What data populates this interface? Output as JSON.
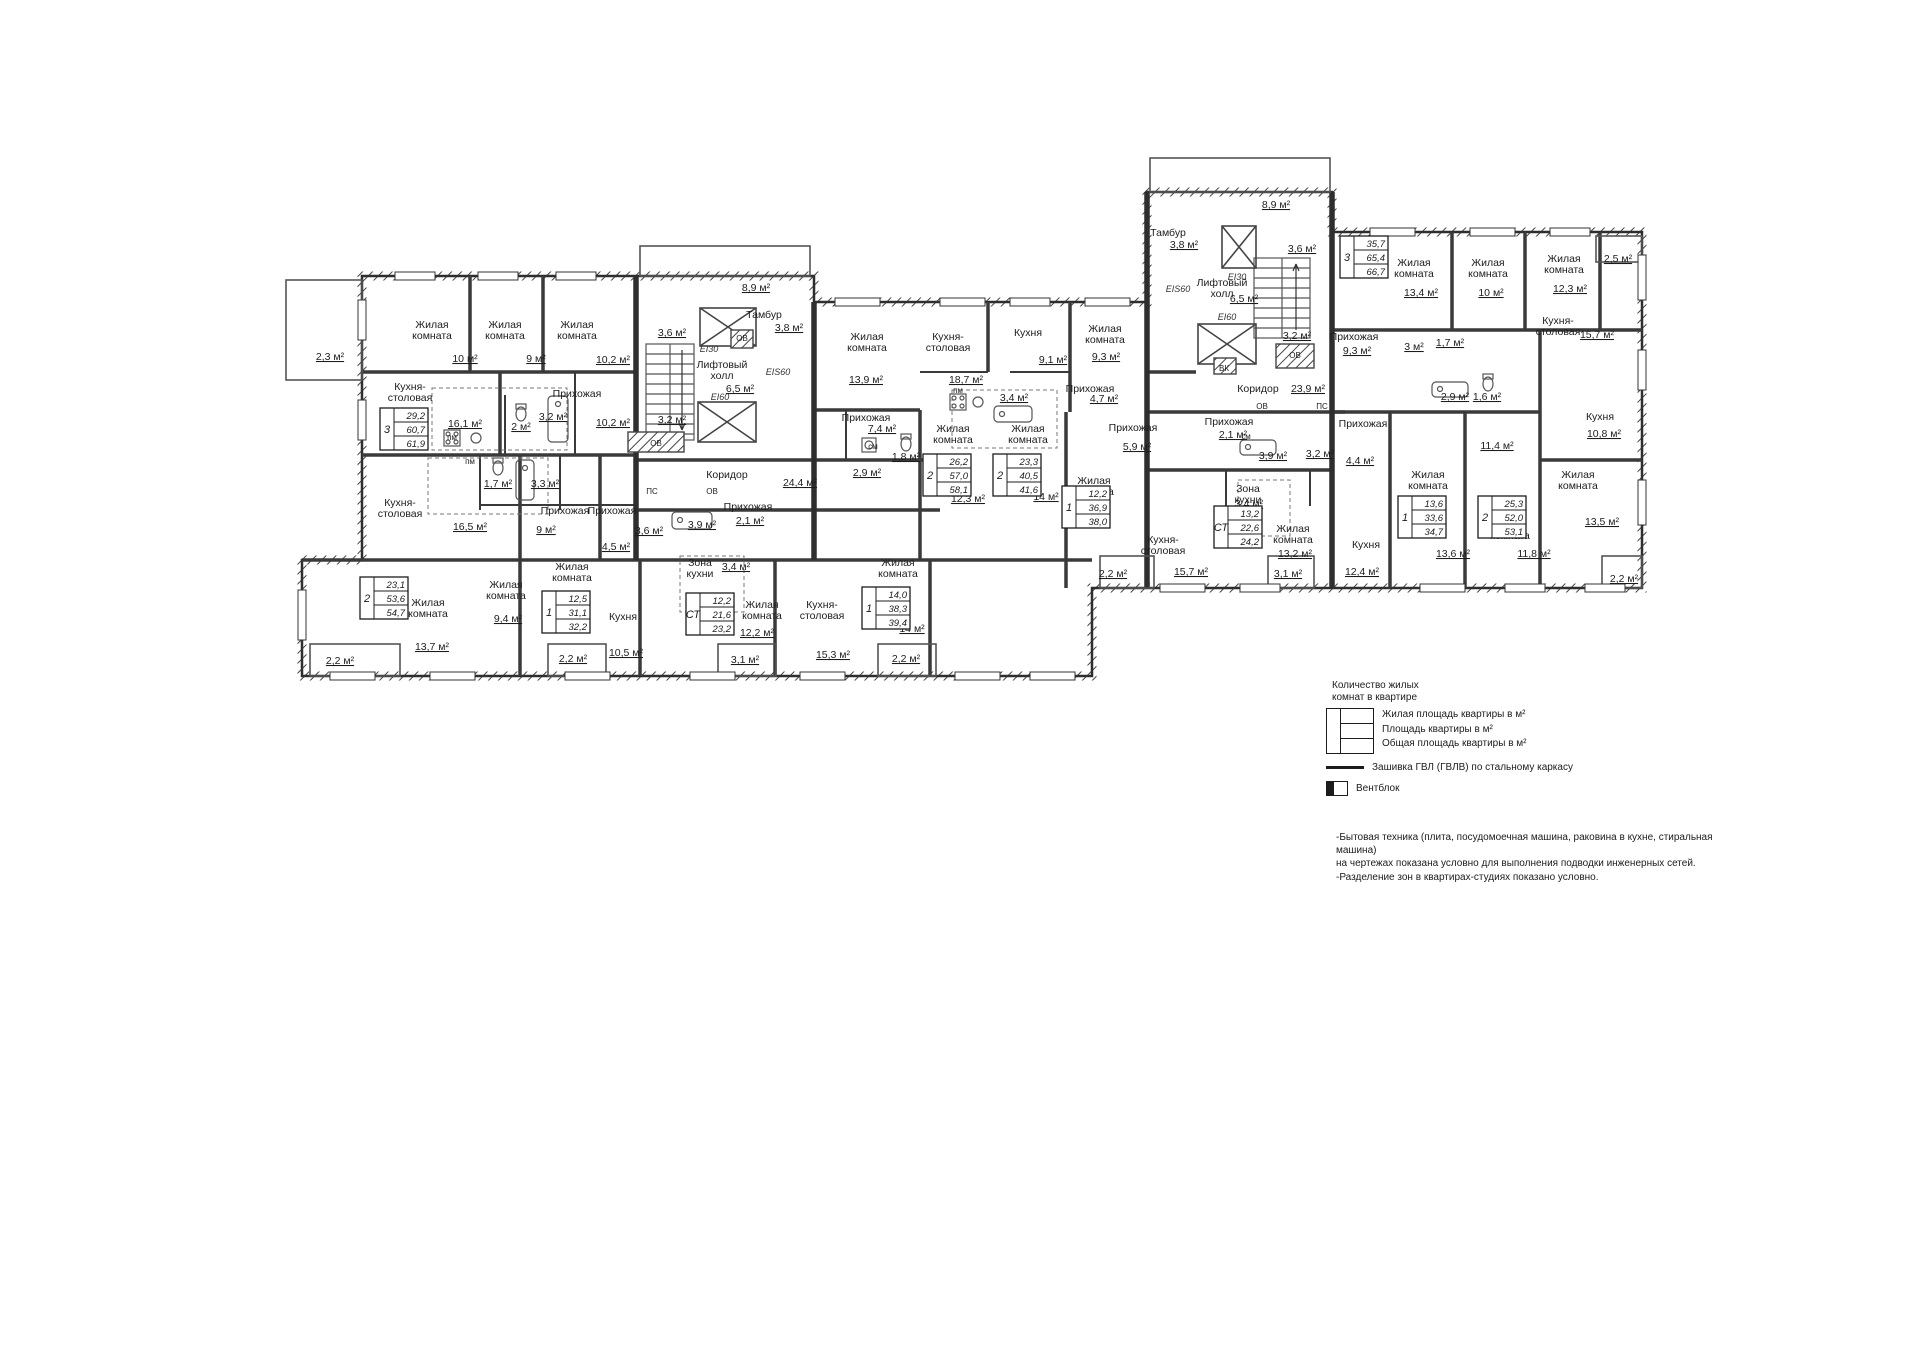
{
  "colors": {
    "ink": "#1c1c1c",
    "wall": "#2e2e2e",
    "wall_light": "#555555"
  },
  "plan": {
    "room_labels": [
      {
        "l": [
          "Жилая",
          "комната"
        ],
        "x": 432,
        "y": 328
      },
      {
        "l": [
          "Жилая",
          "комната"
        ],
        "x": 505,
        "y": 328
      },
      {
        "l": [
          "Жилая",
          "комната"
        ],
        "x": 577,
        "y": 328
      },
      {
        "l": [
          "Кухня-",
          "столовая"
        ],
        "x": 410,
        "y": 390
      },
      {
        "l": [
          "Прихожая"
        ],
        "x": 577,
        "y": 397
      },
      {
        "l": [
          "Кухня-",
          "столовая"
        ],
        "x": 400,
        "y": 506
      },
      {
        "l": [
          "Прихожая"
        ],
        "x": 565,
        "y": 514
      },
      {
        "l": [
          "Прихожая"
        ],
        "x": 612,
        "y": 514
      },
      {
        "l": [
          "Прихожая"
        ],
        "x": 748,
        "y": 510
      },
      {
        "l": [
          "Коридор"
        ],
        "x": 727,
        "y": 478
      },
      {
        "l": [
          "Жилая",
          "комната"
        ],
        "x": 428,
        "y": 606
      },
      {
        "l": [
          "Жилая",
          "комната"
        ],
        "x": 506,
        "y": 588
      },
      {
        "l": [
          "Жилая",
          "комната"
        ],
        "x": 572,
        "y": 570
      },
      {
        "l": [
          "Кухня"
        ],
        "x": 623,
        "y": 620
      },
      {
        "l": [
          "Зона",
          "кухни"
        ],
        "x": 700,
        "y": 566
      },
      {
        "l": [
          "Жилая",
          "комната"
        ],
        "x": 762,
        "y": 608
      },
      {
        "l": [
          "Кухня-",
          "столовая"
        ],
        "x": 822,
        "y": 608
      },
      {
        "l": [
          "Жилая",
          "комната"
        ],
        "x": 898,
        "y": 566
      },
      {
        "l": [
          "Тамбур"
        ],
        "x": 764,
        "y": 318
      },
      {
        "l": [
          "Лифтовый",
          "холл"
        ],
        "x": 722,
        "y": 368
      },
      {
        "l": [
          "Жилая",
          "комната"
        ],
        "x": 867,
        "y": 340
      },
      {
        "l": [
          "Кухня-",
          "столовая"
        ],
        "x": 948,
        "y": 340
      },
      {
        "l": [
          "Прихожая"
        ],
        "x": 866,
        "y": 421
      },
      {
        "l": [
          "Жилая",
          "комната"
        ],
        "x": 953,
        "y": 432
      },
      {
        "l": [
          "Кухня"
        ],
        "x": 1028,
        "y": 336
      },
      {
        "l": [
          "Жилая",
          "комната"
        ],
        "x": 1105,
        "y": 332
      },
      {
        "l": [
          "Прихожая"
        ],
        "x": 1090,
        "y": 392
      },
      {
        "l": [
          "Жилая",
          "комната"
        ],
        "x": 1028,
        "y": 432
      },
      {
        "l": [
          "Прихожая"
        ],
        "x": 1133,
        "y": 431
      },
      {
        "l": [
          "Жилая",
          "комната"
        ],
        "x": 1094,
        "y": 484
      },
      {
        "l": [
          "Кухня-",
          "столовая"
        ],
        "x": 1163,
        "y": 543
      },
      {
        "l": [
          "Зона",
          "кухни"
        ],
        "x": 1248,
        "y": 492
      },
      {
        "l": [
          "Жилая",
          "комната"
        ],
        "x": 1293,
        "y": 532
      },
      {
        "l": [
          "Тамбур"
        ],
        "x": 1168,
        "y": 236
      },
      {
        "l": [
          "Лифтовый",
          "холл"
        ],
        "x": 1222,
        "y": 286
      },
      {
        "l": [
          "Коридор"
        ],
        "x": 1258,
        "y": 392
      },
      {
        "l": [
          "Прихожая"
        ],
        "x": 1229,
        "y": 425
      },
      {
        "l": [
          "Прихожая"
        ],
        "x": 1363,
        "y": 427
      },
      {
        "l": [
          "Прихожая"
        ],
        "x": 1354,
        "y": 340
      },
      {
        "l": [
          "Жилая",
          "комната"
        ],
        "x": 1414,
        "y": 266
      },
      {
        "l": [
          "Жилая",
          "комната"
        ],
        "x": 1488,
        "y": 266
      },
      {
        "l": [
          "Жилая",
          "комната"
        ],
        "x": 1564,
        "y": 262
      },
      {
        "l": [
          "Кухня-",
          "столовая"
        ],
        "x": 1558,
        "y": 324
      },
      {
        "l": [
          "Кухня"
        ],
        "x": 1600,
        "y": 420
      },
      {
        "l": [
          "Жилая",
          "комната"
        ],
        "x": 1578,
        "y": 478
      },
      {
        "l": [
          "Жилая",
          "комната"
        ],
        "x": 1428,
        "y": 478
      },
      {
        "l": [
          "Кухня"
        ],
        "x": 1366,
        "y": 548
      },
      {
        "l": [
          "Жилая",
          "комната"
        ],
        "x": 1510,
        "y": 528
      }
    ],
    "area_labels": [
      {
        "t": "10 м²",
        "x": 465,
        "y": 362
      },
      {
        "t": "9 м²",
        "x": 536,
        "y": 362
      },
      {
        "t": "10,2 м²",
        "x": 613,
        "y": 363
      },
      {
        "t": "2,3 м²",
        "x": 330,
        "y": 360
      },
      {
        "t": "16,1 м²",
        "x": 465,
        "y": 427
      },
      {
        "t": "2 м²",
        "x": 521,
        "y": 430
      },
      {
        "t": "3,2 м²",
        "x": 553,
        "y": 420
      },
      {
        "t": "10,2 м²",
        "x": 613,
        "y": 426
      },
      {
        "t": "3,2 м²",
        "x": 672,
        "y": 423
      },
      {
        "t": "1,7 м²",
        "x": 498,
        "y": 487
      },
      {
        "t": "3,3 м²",
        "x": 545,
        "y": 487
      },
      {
        "t": "16,5 м²",
        "x": 470,
        "y": 530
      },
      {
        "t": "9 м²",
        "x": 546,
        "y": 533
      },
      {
        "t": "4,5 м²",
        "x": 616,
        "y": 550
      },
      {
        "t": "3,6 м²",
        "x": 649,
        "y": 534
      },
      {
        "t": "3,9 м²",
        "x": 702,
        "y": 528
      },
      {
        "t": "2,1 м²",
        "x": 750,
        "y": 524
      },
      {
        "t": "24,4 м²",
        "x": 800,
        "y": 486
      },
      {
        "t": "13,7 м²",
        "x": 432,
        "y": 650
      },
      {
        "t": "9,4 м²",
        "x": 508,
        "y": 622
      },
      {
        "t": "2,2 м²",
        "x": 340,
        "y": 664
      },
      {
        "t": "2,2 м²",
        "x": 573,
        "y": 662
      },
      {
        "t": "10,5 м²",
        "x": 626,
        "y": 656
      },
      {
        "t": "3,4 м²",
        "x": 736,
        "y": 570
      },
      {
        "t": "12,2 м²",
        "x": 757,
        "y": 636
      },
      {
        "t": "3,1 м²",
        "x": 745,
        "y": 663
      },
      {
        "t": "15,3 м²",
        "x": 833,
        "y": 658
      },
      {
        "t": "14 м²",
        "x": 912,
        "y": 632
      },
      {
        "t": "2,2 м²",
        "x": 906,
        "y": 662
      },
      {
        "t": "8,9 м²",
        "x": 756,
        "y": 291
      },
      {
        "t": "3,8 м²",
        "x": 789,
        "y": 331
      },
      {
        "t": "3,6 м²",
        "x": 672,
        "y": 336
      },
      {
        "t": "6,5 м²",
        "x": 740,
        "y": 392
      },
      {
        "t": "13,9 м²",
        "x": 866,
        "y": 383
      },
      {
        "t": "18,7 м²",
        "x": 966,
        "y": 383
      },
      {
        "t": "7,4 м²",
        "x": 882,
        "y": 432
      },
      {
        "t": "2,9 м²",
        "x": 867,
        "y": 476
      },
      {
        "t": "1,8 м²",
        "x": 906,
        "y": 460
      },
      {
        "t": "12,3 м²",
        "x": 968,
        "y": 502
      },
      {
        "t": "9,1 м²",
        "x": 1053,
        "y": 363
      },
      {
        "t": "9,3 м²",
        "x": 1106,
        "y": 360
      },
      {
        "t": "4,7 м²",
        "x": 1104,
        "y": 402
      },
      {
        "t": "3,4 м²",
        "x": 1014,
        "y": 401
      },
      {
        "t": "14 м²",
        "x": 1046,
        "y": 500
      },
      {
        "t": "5,9 м²",
        "x": 1137,
        "y": 450
      },
      {
        "t": "2,2 м²",
        "x": 1113,
        "y": 577
      },
      {
        "t": "15,7 м²",
        "x": 1191,
        "y": 575
      },
      {
        "t": "3,4 м²",
        "x": 1249,
        "y": 507
      },
      {
        "t": "13,2 м²",
        "x": 1295,
        "y": 557
      },
      {
        "t": "3,1 м²",
        "x": 1288,
        "y": 577
      },
      {
        "t": "8,9 м²",
        "x": 1276,
        "y": 208
      },
      {
        "t": "3,8 м²",
        "x": 1184,
        "y": 248
      },
      {
        "t": "3,6 м²",
        "x": 1302,
        "y": 252
      },
      {
        "t": "6,5 м²",
        "x": 1244,
        "y": 302
      },
      {
        "t": "23,9 м²",
        "x": 1308,
        "y": 392
      },
      {
        "t": "2,1 м²",
        "x": 1233,
        "y": 438
      },
      {
        "t": "3,9 м²",
        "x": 1273,
        "y": 459
      },
      {
        "t": "3,2 м²",
        "x": 1320,
        "y": 457
      },
      {
        "t": "4,4 м²",
        "x": 1360,
        "y": 464
      },
      {
        "t": "9,3 м²",
        "x": 1357,
        "y": 354
      },
      {
        "t": "13,4 м²",
        "x": 1421,
        "y": 296
      },
      {
        "t": "10 м²",
        "x": 1491,
        "y": 296
      },
      {
        "t": "12,3 м²",
        "x": 1570,
        "y": 292
      },
      {
        "t": "2,5 м²",
        "x": 1618,
        "y": 262
      },
      {
        "t": "15,7 м²",
        "x": 1597,
        "y": 338
      },
      {
        "t": "1,7 м²",
        "x": 1450,
        "y": 346
      },
      {
        "t": "3 м²",
        "x": 1414,
        "y": 350
      },
      {
        "t": "2,9 м²",
        "x": 1455,
        "y": 400
      },
      {
        "t": "1,6 м²",
        "x": 1487,
        "y": 400
      },
      {
        "t": "10,8 м²",
        "x": 1604,
        "y": 437
      },
      {
        "t": "13,5 м²",
        "x": 1602,
        "y": 525
      },
      {
        "t": "11,4 м²",
        "x": 1497,
        "y": 449
      },
      {
        "t": "13,6 м²",
        "x": 1453,
        "y": 557
      },
      {
        "t": "11,8 м²",
        "x": 1534,
        "y": 557
      },
      {
        "t": "12,4 м²",
        "x": 1362,
        "y": 575
      },
      {
        "t": "2,2 м²",
        "x": 1624,
        "y": 582
      },
      {
        "t": "3,2 м²",
        "x": 1297,
        "y": 339
      }
    ],
    "tag_labels": [
      {
        "t": "ПС",
        "x": 652,
        "y": 494
      },
      {
        "t": "ОВ",
        "x": 712,
        "y": 494
      },
      {
        "t": "ОВ",
        "x": 656,
        "y": 446
      },
      {
        "t": "ОВ",
        "x": 742,
        "y": 341
      },
      {
        "t": "ВК",
        "x": 1224,
        "y": 371
      },
      {
        "t": "ОВ",
        "x": 1295,
        "y": 358
      },
      {
        "t": "ПС",
        "x": 1322,
        "y": 409
      },
      {
        "t": "ОВ",
        "x": 1262,
        "y": 409
      },
      {
        "t": "пм",
        "x": 452,
        "y": 440
      },
      {
        "t": "пм",
        "x": 470,
        "y": 464
      },
      {
        "t": "пм",
        "x": 958,
        "y": 393
      },
      {
        "t": "см",
        "x": 873,
        "y": 449
      },
      {
        "t": "см",
        "x": 1246,
        "y": 439
      }
    ],
    "ei_labels": [
      {
        "t": "EI30",
        "x": 709,
        "y": 352
      },
      {
        "t": "EI60",
        "x": 720,
        "y": 400
      },
      {
        "t": "EIS60",
        "x": 778,
        "y": 375
      },
      {
        "t": "EI30",
        "x": 1237,
        "y": 280
      },
      {
        "t": "EI60",
        "x": 1227,
        "y": 320
      },
      {
        "t": "EIS60",
        "x": 1178,
        "y": 292
      }
    ],
    "tables": [
      {
        "x": 380,
        "y": 408,
        "rooms": "3",
        "living": "29,2",
        "area": "60,7",
        "total": "61,9"
      },
      {
        "x": 360,
        "y": 577,
        "rooms": "2",
        "living": "23,1",
        "area": "53,6",
        "total": "54,7"
      },
      {
        "x": 542,
        "y": 591,
        "rooms": "1",
        "living": "12,5",
        "area": "31,1",
        "total": "32,2"
      },
      {
        "x": 686,
        "y": 593,
        "rooms": "СТ",
        "living": "12,2",
        "area": "21,6",
        "total": "23,2"
      },
      {
        "x": 862,
        "y": 587,
        "rooms": "1",
        "living": "14,0",
        "area": "38,3",
        "total": "39,4"
      },
      {
        "x": 923,
        "y": 454,
        "rooms": "2",
        "living": "26,2",
        "area": "57,0",
        "total": "58,1"
      },
      {
        "x": 993,
        "y": 454,
        "rooms": "2",
        "living": "23,3",
        "area": "40,5",
        "total": "41,6"
      },
      {
        "x": 1062,
        "y": 486,
        "rooms": "1",
        "living": "12,2",
        "area": "36,9",
        "total": "38,0"
      },
      {
        "x": 1214,
        "y": 506,
        "rooms": "СТ",
        "living": "13,2",
        "area": "22,6",
        "total": "24,2"
      },
      {
        "x": 1398,
        "y": 496,
        "rooms": "1",
        "living": "13,6",
        "area": "33,6",
        "total": "34,7"
      },
      {
        "x": 1478,
        "y": 496,
        "rooms": "2",
        "living": "25,3",
        "area": "52,0",
        "total": "53,1"
      },
      {
        "x": 1340,
        "y": 236,
        "rooms": "3",
        "living": "35,7",
        "area": "65,4",
        "total": "66,7"
      }
    ]
  },
  "legend": {
    "title_line1": "Количество жилых",
    "title_line2": "комнат в квартире",
    "row_living": "Жилая площадь квартиры в м²",
    "row_area": "Площадь квартиры в м²",
    "row_total": "Общая площадь квартиры в м²",
    "hatch_label": "Зашивка ГВЛ (ГВЛВ) по стальному каркасу",
    "vent_label": "Вентблок"
  },
  "notes": [
    "-Бытовая техника (плита, посудомоечная машина, раковина в кухне, стиральная машина)",
    " на чертежах показана условно для выполнения подводки инженерных сетей.",
    "-Разделение зон в квартирах-студиях показано условно."
  ]
}
